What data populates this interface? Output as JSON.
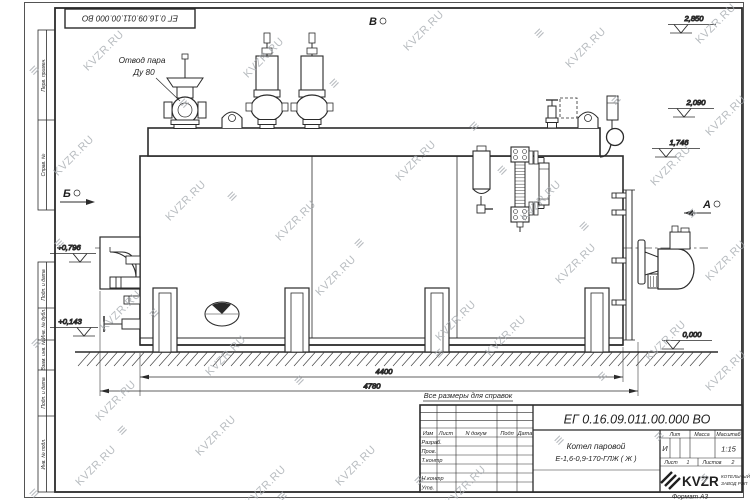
{
  "watermark": {
    "text": "KVZR.RU",
    "logo_glyph": "≡",
    "text_positions": [
      [
        78,
        45
      ],
      [
        238,
        52
      ],
      [
        398,
        25
      ],
      [
        560,
        42
      ],
      [
        690,
        18
      ],
      [
        48,
        150
      ],
      [
        160,
        195
      ],
      [
        270,
        215
      ],
      [
        390,
        155
      ],
      [
        515,
        195
      ],
      [
        645,
        160
      ],
      [
        700,
        110
      ],
      [
        95,
        305
      ],
      [
        200,
        350
      ],
      [
        310,
        270
      ],
      [
        430,
        315
      ],
      [
        550,
        258
      ],
      [
        640,
        335
      ],
      [
        700,
        255
      ],
      [
        70,
        460
      ],
      [
        190,
        430
      ],
      [
        330,
        460
      ],
      [
        90,
        395
      ],
      [
        480,
        330
      ],
      [
        700,
        365
      ],
      [
        240,
        480
      ],
      [
        440,
        480
      ]
    ],
    "logo_positions": [
      [
        30,
        62
      ],
      [
        180,
        95
      ],
      [
        330,
        75
      ],
      [
        470,
        118
      ],
      [
        612,
        92
      ],
      [
        55,
        235
      ],
      [
        228,
        188
      ],
      [
        355,
        235
      ],
      [
        498,
        162
      ],
      [
        580,
        218
      ],
      [
        688,
        205
      ],
      [
        32,
        335
      ],
      [
        150,
        305
      ],
      [
        295,
        372
      ],
      [
        435,
        345
      ],
      [
        598,
        368
      ],
      [
        118,
        422
      ],
      [
        278,
        488
      ],
      [
        415,
        472
      ],
      [
        555,
        432
      ],
      [
        700,
        470
      ],
      [
        535,
        25
      ],
      [
        655,
        428
      ],
      [
        30,
        485
      ]
    ]
  },
  "stamp_top": "ЕГ 0.16.09.011.00.000  ВО",
  "annotations": {
    "steam_outlet_line1": "Отвод пара",
    "steam_outlet_line2": "Ду 80",
    "view_b": "Б",
    "view_v": "В",
    "view_a": "А",
    "reference_note": "Все размеры для справок"
  },
  "elevations": [
    "2,850",
    "2,090",
    "1,746",
    "+0,796",
    "+0,143",
    "0,000"
  ],
  "dimensions": [
    "4400",
    "4780"
  ],
  "margin_labels": [
    "Перв. примен.",
    "Справ. №",
    "Подп. и дата",
    "Инв. № дубл.",
    "Взам. инв. №",
    "Подп. и дата",
    "Инв. № подл."
  ],
  "title_block": {
    "doc_number": "ЕГ 0.16.09.011.00.000  ВО",
    "cols": {
      "izm": "Изм",
      "list": "Лист",
      "ndoc": "N докум",
      "podp": "Подп",
      "data": "Дата"
    },
    "rows": {
      "razrab": "Разраб.",
      "prov": "Пров.",
      "tkontr": "Т.контр",
      "nkontr": "Н.контр",
      "utv": "Утв."
    },
    "product_line1": "Котел паровой",
    "product_line2": "Е-1,6-0,9-170-ГЛЖ ( Ж )",
    "lit_label": "Лит",
    "lit_value": "И",
    "massa_label": "Масса",
    "masshtab_label": "Масштаб",
    "scale_value": "1:15",
    "sheet_label": "Лист",
    "sheet_value": "1",
    "sheets_label": "Листов",
    "sheets_value": "2",
    "logo_text": "KVZR",
    "logo_sub1": "КОТЕЛЬНЫЙ",
    "logo_sub2": "ЗАВОД РЭП",
    "format_label": "Формат А3"
  }
}
